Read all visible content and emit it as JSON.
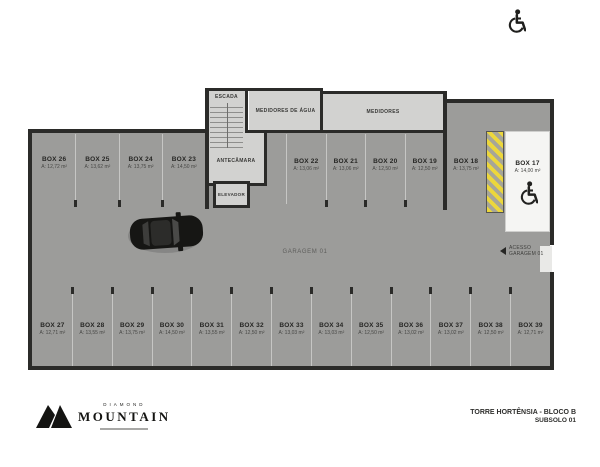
{
  "title_block": {
    "line1": "TORRE HORTÊNSIA - BLOCO B",
    "line2": "SUBSOLO 01"
  },
  "brand": {
    "top": "DIAMOND",
    "name": "MOUNTAIN"
  },
  "rooms": {
    "escada": "ESCADA",
    "medidores_agua": "MEDIDORES DE ÁGUA",
    "medidores": "MEDIDORES",
    "antecamara": "ANTECÂMARA",
    "elevador": "ELEVADOR"
  },
  "garage_label": "GARAGEM 01",
  "access": {
    "line1": "ACESSO",
    "line2": "GARAGEM 01"
  },
  "stalls_top_left": [
    {
      "label": "BOX 26",
      "area": "A: 12,72 m²"
    },
    {
      "label": "BOX 25",
      "area": "A: 13,62 m²"
    },
    {
      "label": "BOX 24",
      "area": "A: 13,75 m²"
    },
    {
      "label": "BOX 23",
      "area": "A: 14,50 m²"
    }
  ],
  "stalls_top_right": [
    {
      "label": "BOX 22",
      "area": "A: 13,06 m²"
    },
    {
      "label": "BOX 21",
      "area": "A: 13,06 m²"
    },
    {
      "label": "BOX 20",
      "area": "A: 12,50 m²"
    },
    {
      "label": "BOX 19",
      "area": "A: 12,50 m²"
    }
  ],
  "stall_18": {
    "label": "BOX 18",
    "area": "A: 13,75 m²"
  },
  "stall_17": {
    "label": "BOX 17",
    "area": "A: 14,00 m²"
  },
  "stalls_bottom": [
    {
      "label": "BOX 27",
      "area": "A: 12,71 m²"
    },
    {
      "label": "BOX 28",
      "area": "A: 13,55 m²"
    },
    {
      "label": "BOX 29",
      "area": "A: 13,75 m²"
    },
    {
      "label": "BOX 30",
      "area": "A: 14,50 m²"
    },
    {
      "label": "BOX 31",
      "area": "A: 13,55 m²"
    },
    {
      "label": "BOX 32",
      "area": "A: 12,50 m²"
    },
    {
      "label": "BOX 33",
      "area": "A: 13,03 m²"
    },
    {
      "label": "BOX 34",
      "area": "A: 13,03 m²"
    },
    {
      "label": "BOX 35",
      "area": "A: 12,50 m²"
    },
    {
      "label": "BOX 36",
      "area": "A: 13,02 m²"
    },
    {
      "label": "BOX 37",
      "area": "A: 13,02 m²"
    },
    {
      "label": "BOX 38",
      "area": "A: 12,50 m²"
    },
    {
      "label": "BOX 39",
      "area": "A: 12,71 m²"
    }
  ],
  "colors": {
    "floor": "#9c9c9a",
    "room_floor": "#d2d2d0",
    "wall": "#2b2b29",
    "hatch_yellow": "#ecd73c",
    "accessible_floor": "#f5f5f3"
  }
}
